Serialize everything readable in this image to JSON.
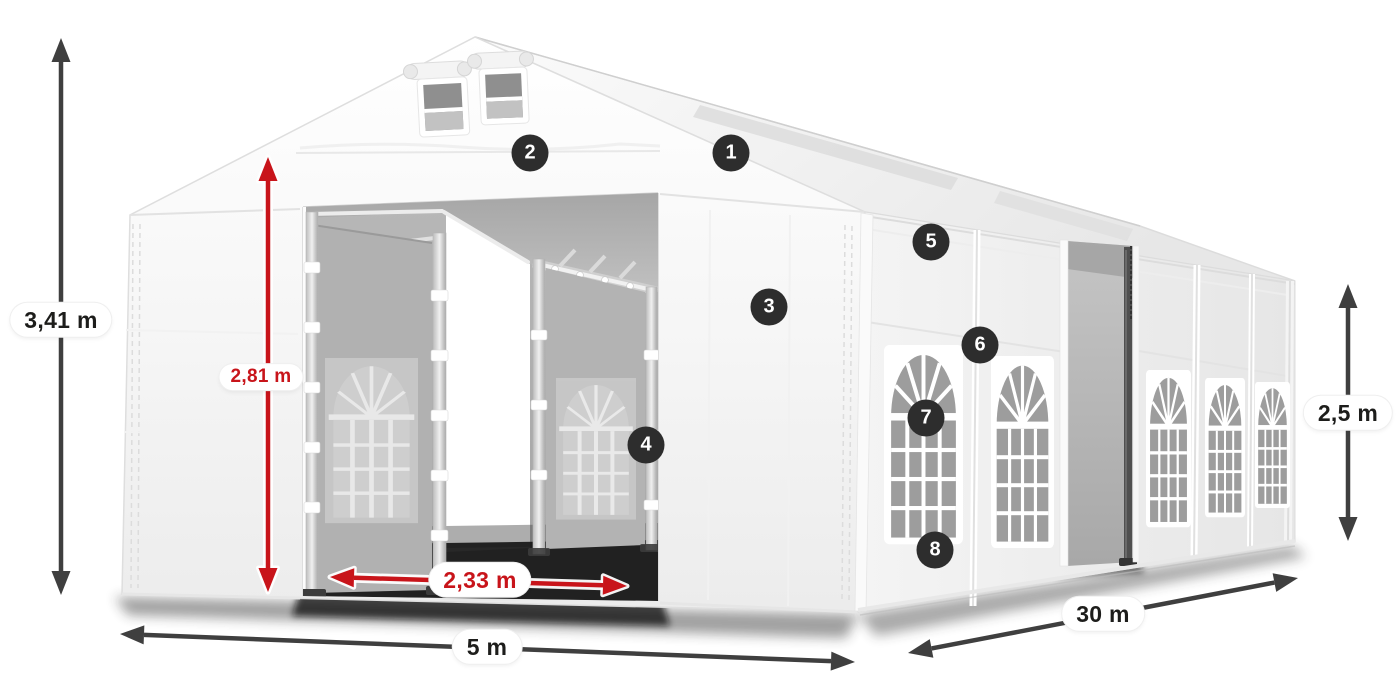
{
  "dimensions": {
    "total_height": {
      "value": "3,41 m",
      "emphasis": "default"
    },
    "door_height": {
      "value": "2,81 m",
      "emphasis": "accent"
    },
    "door_width": {
      "value": "2,33 m",
      "emphasis": "accent"
    },
    "front_width": {
      "value": "5 m",
      "emphasis": "default"
    },
    "side_length": {
      "value": "30 m",
      "emphasis": "default"
    },
    "side_height": {
      "value": "2,5 m",
      "emphasis": "default"
    }
  },
  "callouts": [
    {
      "number": "1"
    },
    {
      "number": "2"
    },
    {
      "number": "3"
    },
    {
      "number": "4"
    },
    {
      "number": "5"
    },
    {
      "number": "6"
    },
    {
      "number": "7"
    },
    {
      "number": "8"
    }
  ],
  "colors": {
    "accent_red": "#c8141a",
    "arrow_dark": "#3f3f3f",
    "badge_bg": "#2d2d2d",
    "label_text": "#1d1d1b"
  }
}
